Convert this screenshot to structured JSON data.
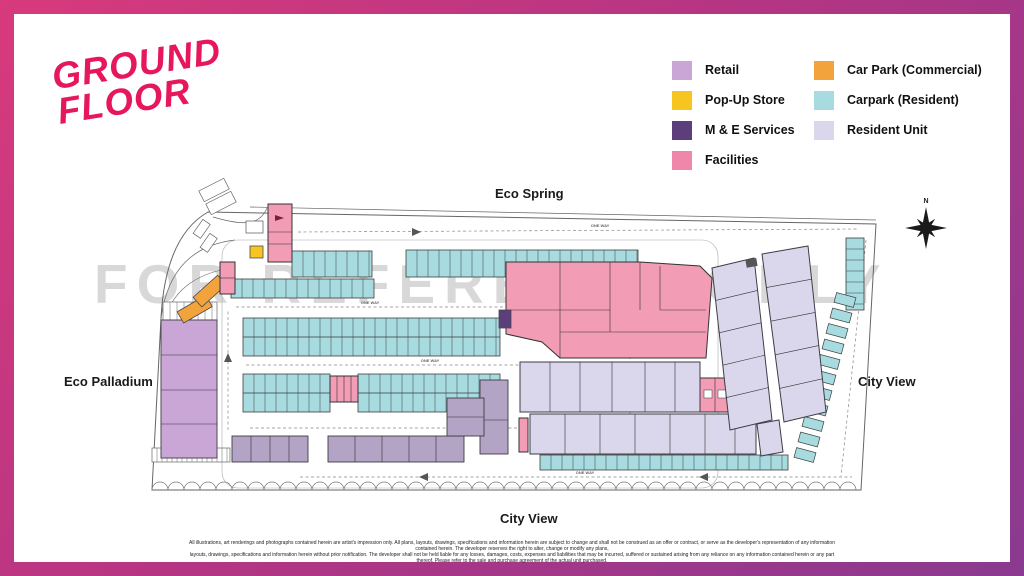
{
  "frame": {
    "gradient_start": "#D83A7C",
    "gradient_end": "#8A3A90"
  },
  "title": {
    "line1": "GROUND",
    "line2": "FLOOR",
    "color": "#E7175E"
  },
  "legend": {
    "col1": [
      {
        "label": "Retail",
        "color": "#C9A6D6"
      },
      {
        "label": "Pop-Up Store",
        "color": "#F6C51F"
      },
      {
        "label": "M & E Services",
        "color": "#5C3E7D"
      },
      {
        "label": "Facilities",
        "color": "#EF87AA"
      }
    ],
    "col2": [
      {
        "label": "Car Park (Commercial)",
        "color": "#F2A33C"
      },
      {
        "label": "Carpark (Resident)",
        "color": "#A7DBE0"
      },
      {
        "label": "Resident Unit",
        "color": "#DAD7EC"
      }
    ]
  },
  "map": {
    "watermark": "FOR REFERENCE ONLY",
    "compass": "N",
    "label_top": "Eco Spring",
    "label_left": "Eco Palladium",
    "label_right": "City View",
    "label_bottom": "City View",
    "road_label": "ONE WAY"
  },
  "disclaimer": {
    "line1": "All illustrations, art renderings and photographs contained herein are artist's impression only. All plans, layouts, drawings, specifications and information herein are subject to change and shall not be construed as an offer or contract, or serve as the developer's representation of any information contained herein. The developer reserves the right to alter, change or modify any plans,",
    "line2": "layouts, drawings, specifications and information herein without prior notification. The developer shall not be held liable for any losses, damages, costs, expenses and liabilities that may be incurred, suffered or sustained arising from any reliance on any information contained herein or any part thereof. Please refer to the sale and purchase agreement of the actual unit purchased."
  }
}
